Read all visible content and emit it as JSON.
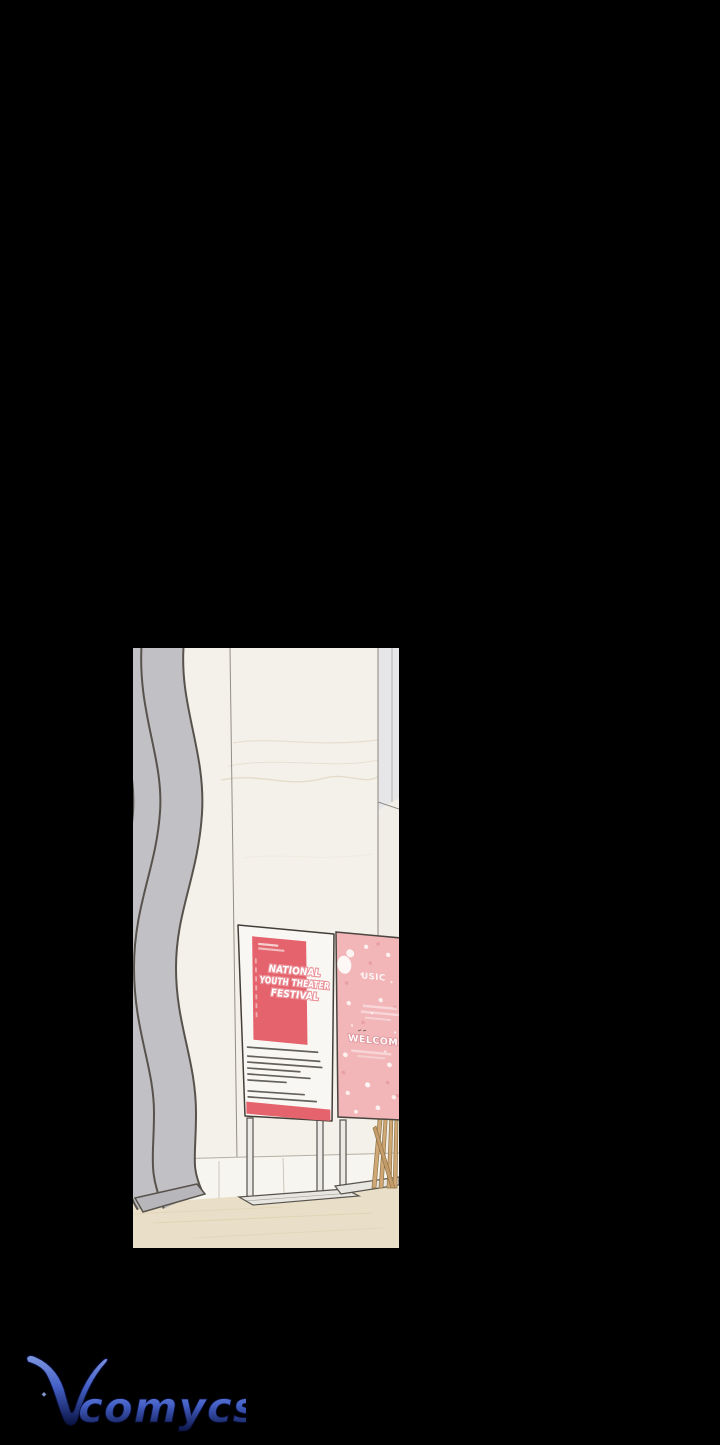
{
  "page": {
    "background": "#000000"
  },
  "panel": {
    "colors": {
      "wall": "#f4f1ea",
      "lower_wall": "#f7f5ef",
      "right_strip": "#e6e5e8",
      "floor": "#e9dfc8",
      "ribbon": "#c1c0c4",
      "ribbon_outline": "#57524c",
      "board": "#f9f7f3",
      "board_outline": "#433e38",
      "poster_red": "#e4636c",
      "pink_sign": "#f2b5b8",
      "pink_sign_dot": "#e59aa1",
      "stand": "#eceae6",
      "plant": "#cfa876"
    },
    "festival_sign": {
      "title_line1": "NATIONAL",
      "title_line2": "YOUTH THEATER",
      "title_line3": "FESTIVAL"
    },
    "welcome_sign": {
      "text_row1": "USIC",
      "text_row2": "WELCOM"
    }
  },
  "watermark": {
    "initial": "V",
    "rest": "comycs",
    "gradient_top": "#8aa4f2",
    "gradient_mid": "#4a68d8",
    "gradient_bottom": "#0c1548"
  }
}
